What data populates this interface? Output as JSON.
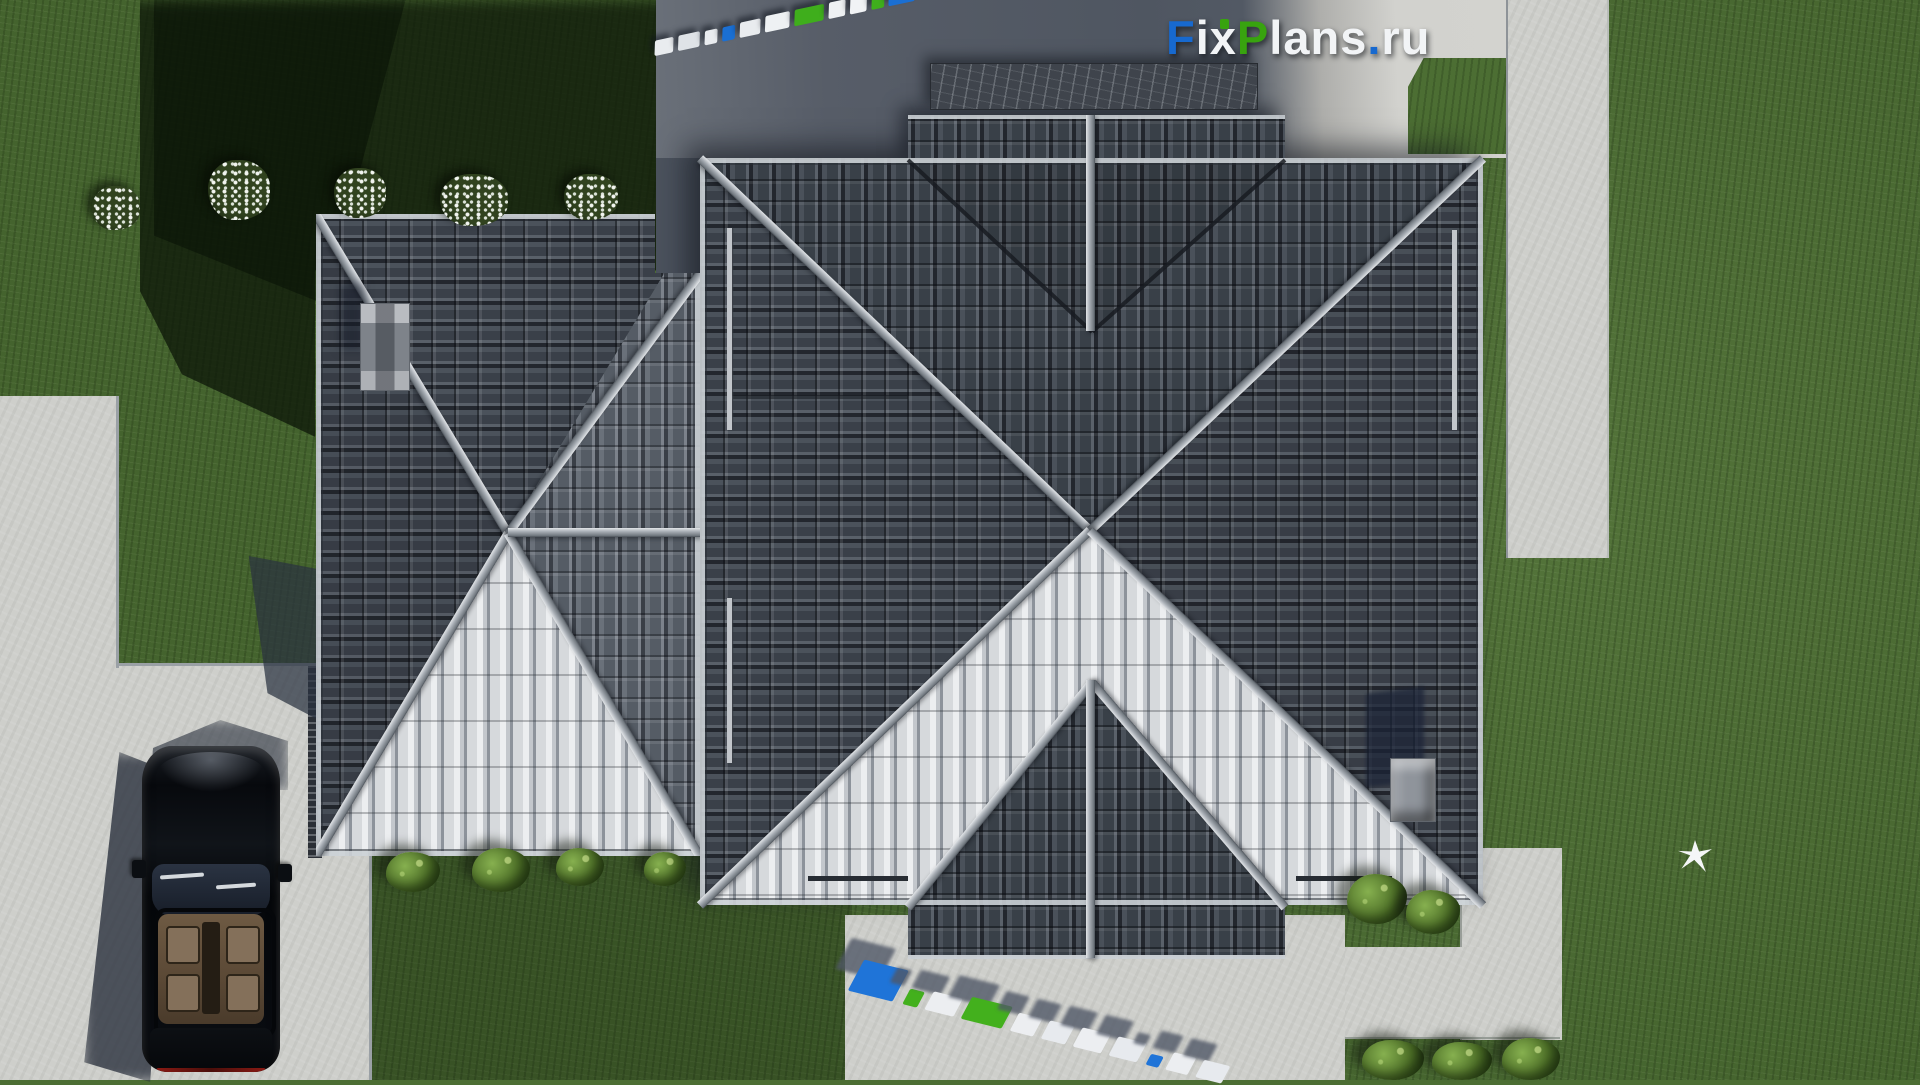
{
  "site_watermark": "FixPlans.ru",
  "logo": {
    "segments": [
      {
        "text": "F",
        "color": "#1769cf"
      },
      {
        "text": "ix",
        "color": "#f2f4f6"
      },
      {
        "text": "P",
        "color": "#38a30f"
      },
      {
        "text": "lans",
        "color": "#f2f4f6"
      },
      {
        "text": ".",
        "color": "#1769cf"
      },
      {
        "text": "ru",
        "color": "#f2f4f6"
      }
    ]
  },
  "watermarks": {
    "top": {
      "label": "FixPlans.ru",
      "slabs": [
        {
          "c": "#e9ecef",
          "w": 19,
          "h": 15
        },
        {
          "c": "#dfe3e7",
          "w": 22,
          "h": 15
        },
        {
          "c": "#e9ecef",
          "w": 13,
          "h": 14
        },
        {
          "c": "#1a6fd3",
          "w": 13,
          "h": 14
        },
        {
          "c": "#e9ecef",
          "w": 21,
          "h": 15
        },
        {
          "c": "#eef1f3",
          "w": 25,
          "h": 16
        },
        {
          "c": "#3fae1c",
          "w": 30,
          "h": 16
        },
        {
          "c": "#eef1f3",
          "w": 17,
          "h": 16
        },
        {
          "c": "#f1f3f5",
          "w": 17,
          "h": 17
        },
        {
          "c": "#3fae1c",
          "w": 13,
          "h": 17
        },
        {
          "c": "#1a6fd3",
          "w": 27,
          "h": 22
        }
      ]
    },
    "bottom": {
      "label": "FixPlans.ru",
      "slabs": [
        {
          "c": "#1f74d8",
          "w": 46,
          "h": 34
        },
        {
          "c": "#43b01d",
          "w": 15,
          "h": 17
        },
        {
          "c": "#eceef1",
          "w": 30,
          "h": 20
        },
        {
          "c": "#43b01d",
          "w": 42,
          "h": 24
        },
        {
          "c": "#eceef1",
          "w": 24,
          "h": 20
        },
        {
          "c": "#e7eaee",
          "w": 25,
          "h": 20
        },
        {
          "c": "#eceef1",
          "w": 29,
          "h": 21
        },
        {
          "c": "#e7eaee",
          "w": 29,
          "h": 21
        },
        {
          "c": "#1f74d8",
          "w": 13,
          "h": 12
        },
        {
          "c": "#eceef1",
          "w": 23,
          "h": 19
        },
        {
          "c": "#e7eaee",
          "w": 27,
          "h": 19
        }
      ]
    }
  },
  "scene": {
    "view": "aerial top-down render of a hip-roofed house with driveway and lawn",
    "objects": {
      "roof_sections": 2,
      "chimneys": 2,
      "car": "black sedan parked on driveway",
      "flower_bushes": 5,
      "green_bushes": 9,
      "bird": "white bird on lawn"
    },
    "colors": {
      "lawn": "#4c6e33",
      "lawn_shadow": "#1c2a14",
      "concrete": "#cecfcb",
      "concrete_shadow": "#565d68",
      "roof_dark": "#3e444d",
      "roof_light": "#b8bcc2",
      "ridge": "#a7adb4",
      "car": "#0a0c10",
      "brand_blue": "#1769cf",
      "brand_green": "#38a30f"
    }
  }
}
